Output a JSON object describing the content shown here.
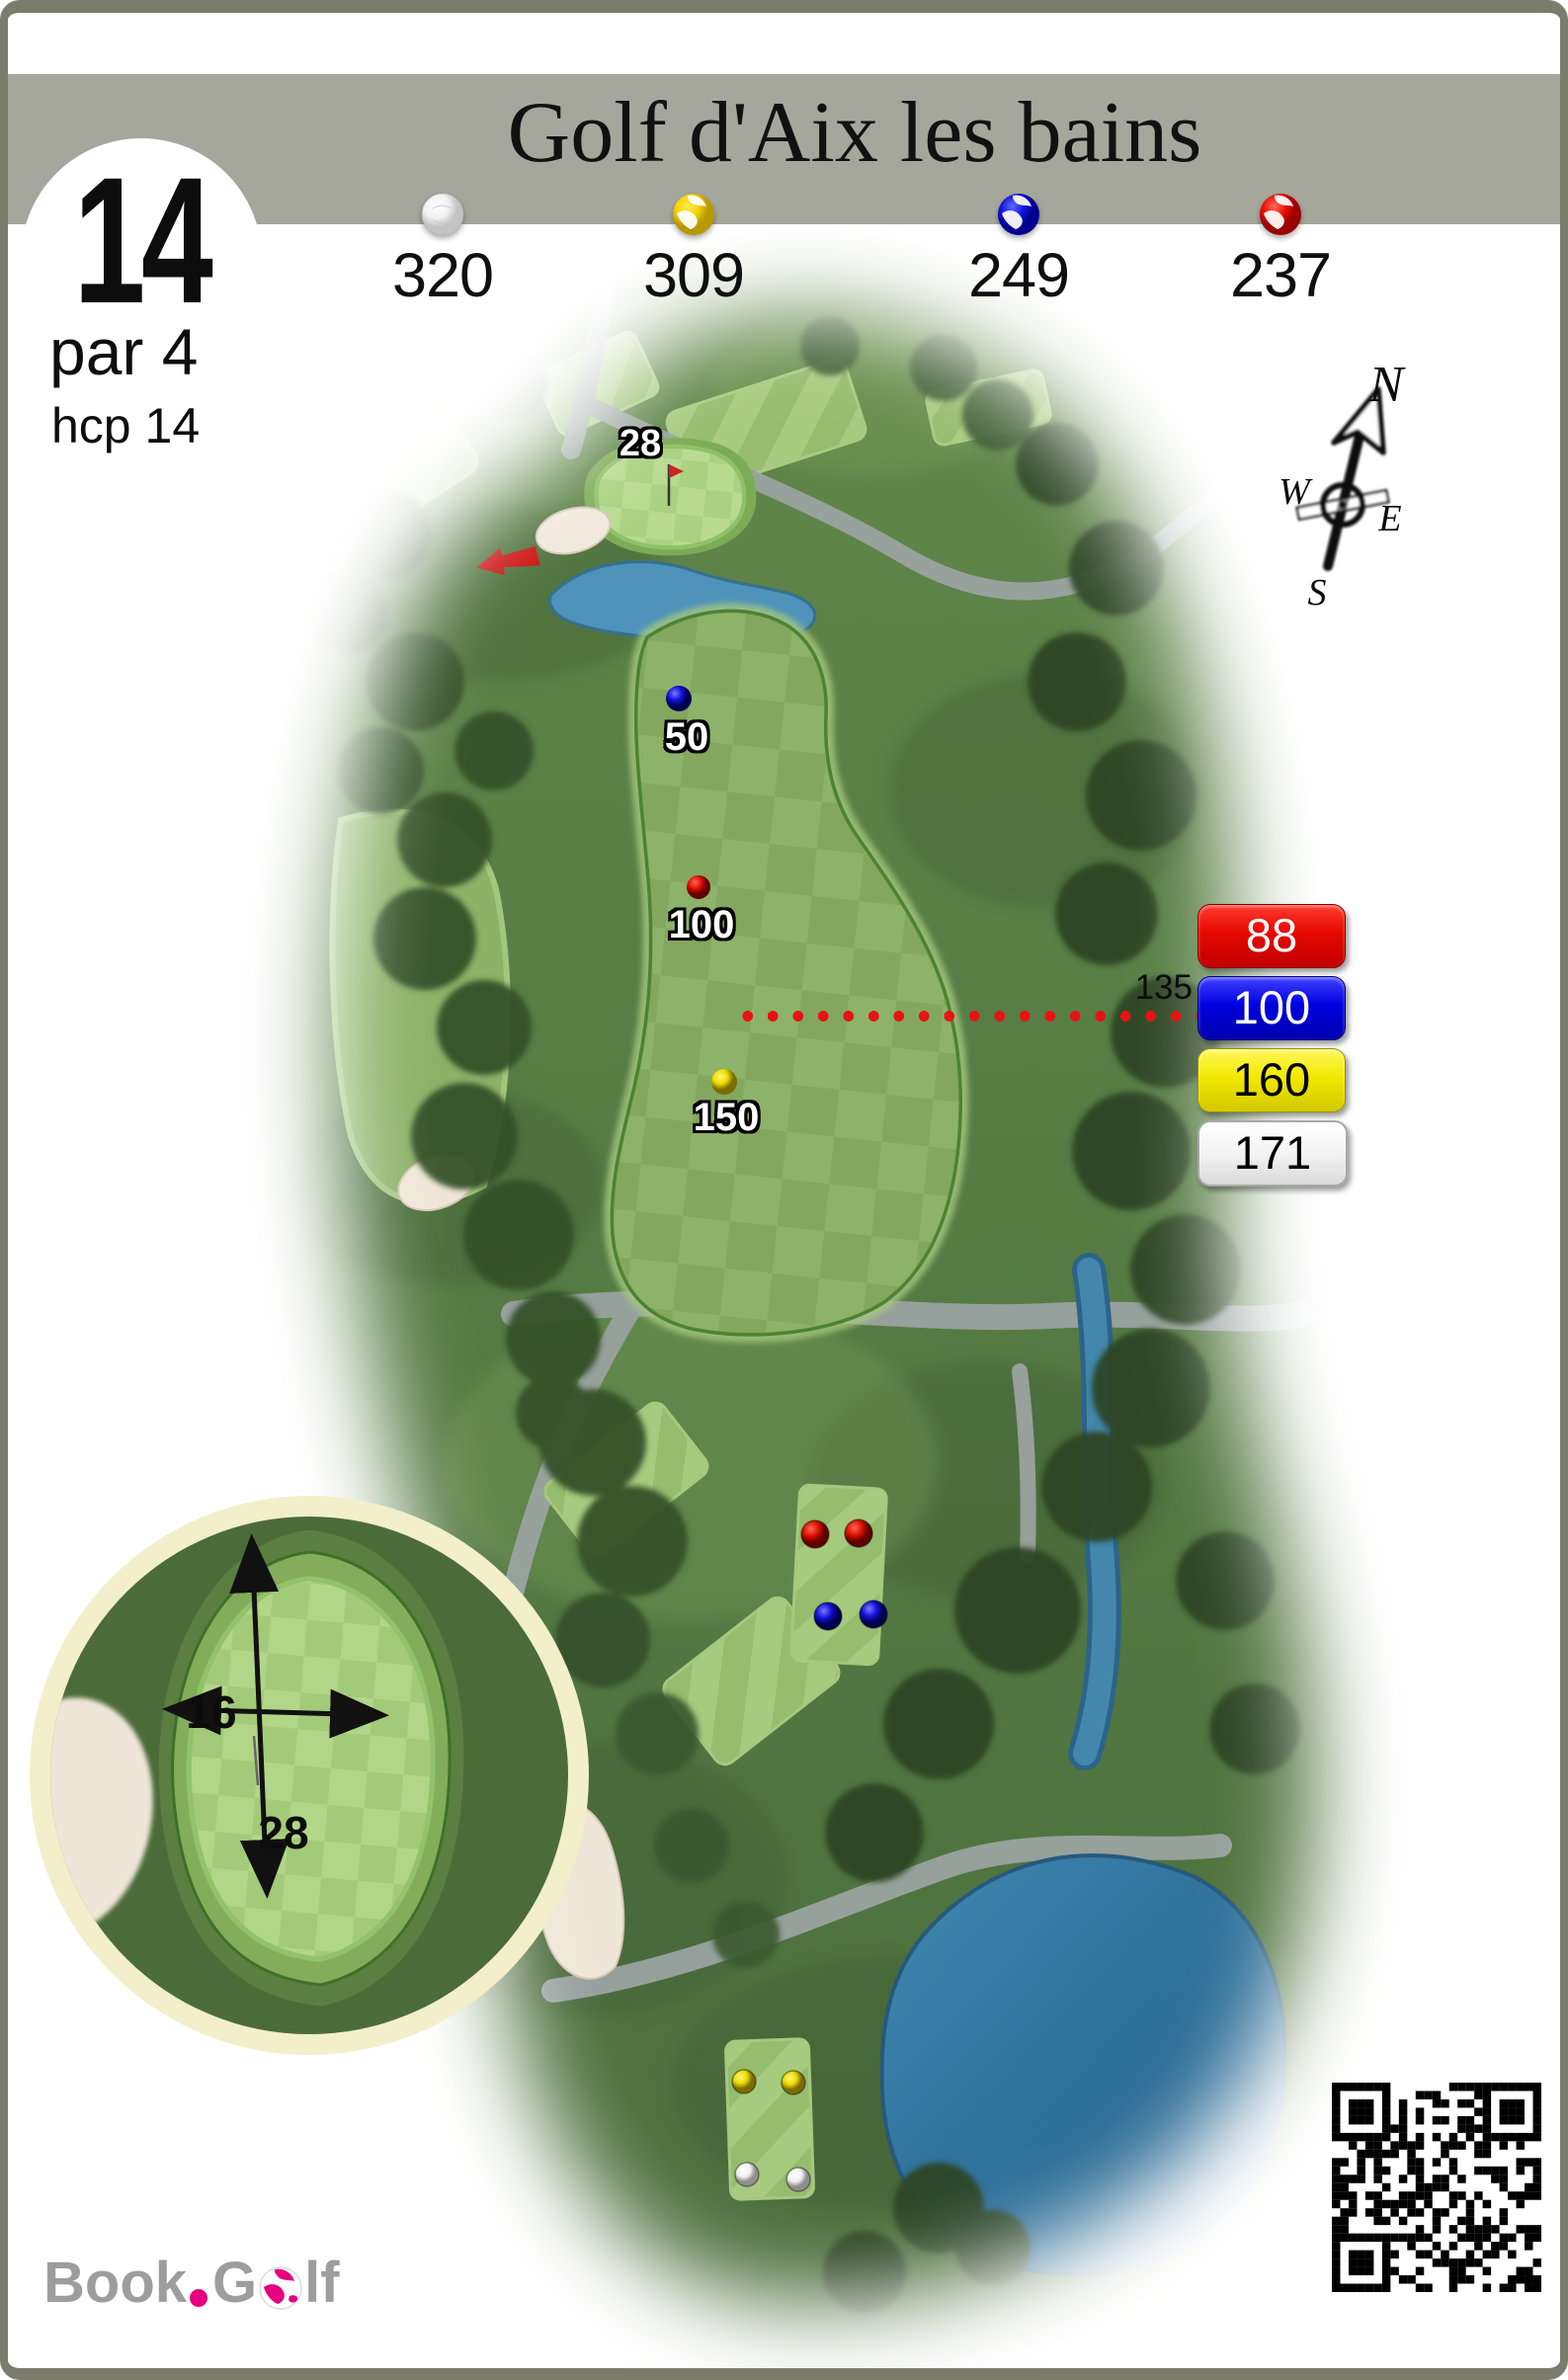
{
  "header": {
    "title": "Golf d'Aix les bains",
    "hole": {
      "number": "14",
      "par": "par 4",
      "handicap": "hcp 14"
    },
    "tees": [
      {
        "name": "white tees",
        "distance": "320"
      },
      {
        "name": "yellow tees",
        "distance": "309"
      },
      {
        "name": "blue tees",
        "distance": "249"
      },
      {
        "name": "red tees",
        "distance": "237"
      }
    ]
  },
  "compass": {
    "north": "N",
    "east": "E",
    "south": "S",
    "west": "W"
  },
  "map": {
    "green_depth_label": "28",
    "markers": [
      {
        "tee": "blue",
        "label": "50"
      },
      {
        "tee": "red",
        "label": "100"
      },
      {
        "tee": "yellow",
        "label": "150"
      }
    ],
    "cross_distance_label": "135",
    "distance_boxes": [
      {
        "tee": "red",
        "value": "88"
      },
      {
        "tee": "blue",
        "value": "100"
      },
      {
        "tee": "yellow",
        "value": "160"
      },
      {
        "tee": "white",
        "value": "171"
      }
    ]
  },
  "green_detail": {
    "width": "16",
    "depth": "28"
  },
  "footer": {
    "logo": {
      "book": "Book",
      "golf_g": "G",
      "golf_lf": "lf"
    }
  },
  "colors": {
    "red": "#e10800",
    "blue": "#0000e0",
    "yellow": "#f2e900",
    "white": "#ffffff",
    "accent_pink": "#e6007d",
    "band_gray": "#a6a79c"
  }
}
